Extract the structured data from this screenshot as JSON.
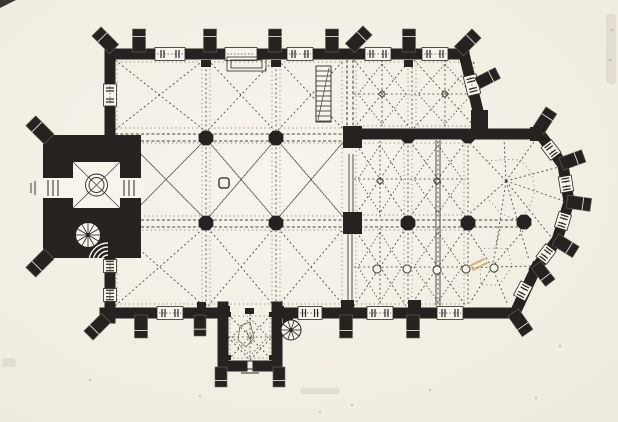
{
  "palette": {
    "paper": "#f7f4ec",
    "paper_edge": "#eeebdf",
    "ink": "#262220",
    "rib": "#4a453e",
    "faint": "#6a6458",
    "thin": "#2b2824",
    "smudge_tan": "#cf9a5c",
    "speck": "#b0aa9c"
  },
  "canvas": {
    "width": 618,
    "height": 422
  },
  "plan": {
    "wall_thickness": 11,
    "walls": [
      [
        110,
        54,
        352,
        54
      ],
      [
        352,
        54,
        464,
        54
      ],
      [
        464,
        54,
        479,
        115
      ],
      [
        352,
        134,
        540,
        134
      ],
      [
        110,
        49,
        110,
        139
      ],
      [
        110,
        251,
        110,
        318
      ],
      [
        105,
        313,
        218,
        313
      ],
      [
        282,
        313,
        515,
        313
      ],
      [
        515,
        313,
        536,
        268
      ],
      [
        540,
        134,
        563,
        165
      ],
      [
        563,
        165,
        569,
        202
      ],
      [
        569,
        202,
        557,
        240
      ],
      [
        557,
        240,
        536,
        268
      ],
      [
        223,
        307,
        223,
        366
      ],
      [
        277,
        307,
        277,
        366
      ],
      [
        223,
        366,
        242,
        366
      ],
      [
        258,
        366,
        277,
        366
      ]
    ],
    "windows": [
      {
        "c": [
          170,
          54
        ],
        "len": 30,
        "ang": 0
      },
      {
        "c": [
          241,
          54
        ],
        "len": 32,
        "ang": 0,
        "door": true
      },
      {
        "c": [
          300,
          54
        ],
        "len": 26,
        "ang": 0
      },
      {
        "c": [
          378,
          54
        ],
        "len": 26,
        "ang": 0
      },
      {
        "c": [
          435,
          54
        ],
        "len": 26,
        "ang": 0
      },
      {
        "c": [
          472,
          85
        ],
        "len": 20,
        "ang": 76
      },
      {
        "c": [
          110,
          95
        ],
        "len": 22,
        "ang": 90
      },
      {
        "c": [
          110,
          266
        ],
        "len": 13,
        "ang": 90
      },
      {
        "c": [
          110,
          295
        ],
        "len": 13,
        "ang": 90
      },
      {
        "c": [
          170,
          313
        ],
        "len": 26,
        "ang": 0
      },
      {
        "c": [
          310,
          313
        ],
        "len": 24,
        "ang": 0
      },
      {
        "c": [
          380,
          313
        ],
        "len": 26,
        "ang": 0
      },
      {
        "c": [
          450,
          313
        ],
        "len": 26,
        "ang": 0
      },
      {
        "c": [
          523,
          291
        ],
        "len": 16,
        "ang": 118
      },
      {
        "c": [
          551,
          150
        ],
        "len": 16,
        "ang": 53
      },
      {
        "c": [
          566,
          184
        ],
        "len": 16,
        "ang": 81
      },
      {
        "c": [
          563,
          221
        ],
        "len": 16,
        "ang": 107
      },
      {
        "c": [
          546,
          254
        ],
        "len": 16,
        "ang": 127
      }
    ],
    "buttresses": [
      [
        139,
        49,
        -90,
        20,
        13
      ],
      [
        210,
        49,
        -90,
        20,
        13
      ],
      [
        275,
        49,
        -90,
        20,
        13
      ],
      [
        332,
        49,
        -90,
        20,
        13
      ],
      [
        409,
        49,
        -90,
        20,
        13
      ],
      [
        112,
        47,
        -135,
        22,
        13
      ],
      [
        352,
        46,
        -45,
        22,
        13
      ],
      [
        461,
        49,
        -45,
        22,
        13
      ],
      [
        480,
        82,
        -27,
        20,
        12
      ],
      [
        540,
        128,
        -57,
        21,
        13
      ],
      [
        564,
        163,
        -20,
        21,
        13
      ],
      [
        570,
        202,
        8,
        21,
        13
      ],
      [
        558,
        241,
        32,
        21,
        13
      ],
      [
        538,
        267,
        52,
        20,
        12
      ],
      [
        515,
        315,
        55,
        22,
        13
      ],
      [
        141,
        318,
        90,
        20,
        13
      ],
      [
        200,
        318,
        90,
        18,
        12
      ],
      [
        346,
        318,
        90,
        20,
        13
      ],
      [
        413,
        318,
        90,
        20,
        13
      ],
      [
        104,
        320,
        135,
        22,
        13
      ],
      [
        221,
        370,
        90,
        17,
        12
      ],
      [
        279,
        370,
        90,
        17,
        12
      ],
      [
        47,
        137,
        -135,
        23,
        14
      ],
      [
        47,
        256,
        135,
        23,
        14
      ]
    ],
    "columns": {
      "r": 8,
      "centers": [
        [
          206,
          138
        ],
        [
          276,
          138
        ],
        [
          206,
          223
        ],
        [
          276,
          223
        ],
        [
          408,
          136
        ],
        [
          468,
          136
        ],
        [
          408,
          223
        ],
        [
          468,
          223
        ],
        [
          524,
          222
        ]
      ]
    },
    "piers": [
      [
        343,
        126,
        19,
        22
      ],
      [
        343,
        212,
        19,
        22
      ],
      [
        471,
        110,
        17,
        28
      ],
      [
        530,
        127,
        12,
        14
      ],
      [
        218,
        306,
        12,
        10
      ],
      [
        272,
        306,
        12,
        10
      ],
      [
        283,
        314,
        10,
        11
      ]
    ],
    "stubs": [
      [
        201,
        60,
        10,
        7
      ],
      [
        271,
        60,
        10,
        7
      ],
      [
        404,
        60,
        9,
        7
      ],
      [
        341,
        300,
        13,
        8
      ],
      [
        408,
        300,
        13,
        8
      ],
      [
        197,
        302,
        9,
        6
      ],
      [
        226,
        312,
        5,
        5
      ],
      [
        269,
        312,
        5,
        5
      ],
      [
        226,
        355,
        5,
        5
      ],
      [
        269,
        355,
        5,
        5
      ],
      [
        245,
        308,
        9,
        6
      ]
    ],
    "bays_cross": [
      [
        115,
        60,
        204,
        130
      ],
      [
        208,
        60,
        274,
        130
      ],
      [
        278,
        60,
        344,
        130
      ],
      [
        115,
        228,
        204,
        306
      ],
      [
        208,
        228,
        274,
        306
      ],
      [
        278,
        228,
        344,
        306
      ]
    ],
    "bays_cross2": [
      [
        128,
        141,
        204,
        218
      ],
      [
        208,
        141,
        274,
        218
      ],
      [
        278,
        141,
        344,
        218
      ]
    ],
    "bays_star": [
      [
        354,
        60,
        410,
        128
      ],
      [
        414,
        60,
        476,
        128
      ],
      [
        354,
        141,
        406,
        217
      ],
      [
        410,
        141,
        466,
        217
      ],
      [
        354,
        228,
        406,
        306
      ],
      [
        410,
        228,
        466,
        306
      ]
    ],
    "fans": [
      {
        "c": [
          506,
          181
        ],
        "pts": [
          [
            468,
            141
          ],
          [
            504,
            138
          ],
          [
            536,
            139
          ],
          [
            559,
            167
          ],
          [
            564,
            201
          ],
          [
            551,
            237
          ],
          [
            529,
            260
          ],
          [
            496,
            246
          ],
          [
            468,
            215
          ]
        ]
      },
      {
        "c": [
          492,
          267
        ],
        "pts": [
          [
            468,
            230
          ],
          [
            500,
            229
          ],
          [
            523,
            231
          ],
          [
            532,
            266
          ],
          [
            507,
            303
          ],
          [
            470,
            303
          ],
          [
            468,
            268
          ]
        ]
      }
    ],
    "tower": {
      "outer": [
        43,
        135,
        98,
        123
      ],
      "inner": [
        73,
        162,
        47,
        46
      ],
      "circles": [
        11,
        7.5
      ],
      "portal_w": [
        38,
        178,
        35,
        20
      ],
      "portal_e": [
        118,
        178,
        26,
        20
      ],
      "lines_w": [
        48,
        53,
        58
      ],
      "lines_e": [
        124,
        129,
        134
      ],
      "outside_steps": [
        [
          35,
          181,
          35,
          195
        ],
        [
          31,
          183,
          31,
          193
        ]
      ]
    },
    "porch_bay": [
      228,
      314,
      272,
      360
    ],
    "porch_sketch": [
      [
        240,
        326
      ],
      [
        250,
        322
      ],
      [
        254,
        338
      ],
      [
        246,
        347
      ],
      [
        238,
        340
      ],
      [
        240,
        326
      ]
    ],
    "porch_sketch_line": [
      246,
      330,
      252,
      344
    ],
    "thresholds": [
      [
        240,
        369,
        260,
        369
      ],
      [
        241,
        373,
        259,
        373
      ],
      [
        236,
        361,
        264,
        361
      ]
    ],
    "arcades": [
      [
        115,
        134,
        346,
        134
      ],
      [
        115,
        141,
        346,
        141
      ],
      [
        115,
        220,
        518,
        220
      ],
      [
        115,
        227,
        518,
        227
      ],
      [
        347,
        60,
        347,
        130
      ],
      [
        353,
        60,
        353,
        130
      ]
    ],
    "transverse": [
      [
        206,
        60,
        206,
        307
      ],
      [
        276,
        60,
        276,
        307
      ],
      [
        412,
        62,
        412,
        128
      ],
      [
        408,
        141,
        408,
        306
      ],
      [
        468,
        141,
        468,
        306
      ]
    ],
    "step_lines": [
      [
        436,
        140,
        436,
        306
      ],
      [
        440,
        140,
        440,
        306
      ],
      [
        349,
        154,
        349,
        212
      ],
      [
        353,
        154,
        353,
        212
      ],
      [
        348,
        228,
        348,
        306
      ],
      [
        352,
        228,
        352,
        306
      ]
    ],
    "bosses": [
      [
        377,
        269
      ],
      [
        407,
        269
      ],
      [
        437,
        270
      ],
      [
        466,
        269
      ],
      [
        494,
        268
      ]
    ],
    "diamonds": [
      [
        382,
        94
      ],
      [
        445,
        94
      ],
      [
        380,
        181
      ],
      [
        437,
        181
      ]
    ],
    "font": [
      224,
      183,
      10
    ],
    "stair_straight": [
      316,
      66,
      15,
      56
    ],
    "spiral_a": {
      "c": [
        88,
        235
      ],
      "r": 12.5,
      "steps": 12,
      "arc_c": [
        108,
        262
      ],
      "arc_r": [
        7,
        11,
        15,
        19
      ]
    },
    "spiral_b": {
      "c": [
        291,
        330
      ],
      "r": 10,
      "steps": 10
    },
    "north_door_steps": [
      [
        227,
        57,
        39,
        14
      ],
      [
        231,
        60,
        31,
        8
      ]
    ],
    "smudges": {
      "corner_triangle": [
        [
          0,
          0
        ],
        [
          16,
          0
        ],
        [
          0,
          8
        ]
      ],
      "tan_strokes": [
        [
          468,
          267,
          484,
          259
        ],
        [
          473,
          270,
          487,
          263
        ]
      ],
      "specks": [
        [
          90,
          380
        ],
        [
          320,
          412
        ],
        [
          352,
          405
        ],
        [
          536,
          398
        ],
        [
          560,
          346
        ],
        [
          200,
          396
        ],
        [
          430,
          390
        ],
        [
          612,
          30
        ],
        [
          610,
          60
        ]
      ],
      "soft_patches": [
        [
          606,
          14,
          10,
          70
        ],
        [
          2,
          358,
          14,
          9
        ],
        [
          300,
          388,
          40,
          6
        ]
      ]
    }
  }
}
